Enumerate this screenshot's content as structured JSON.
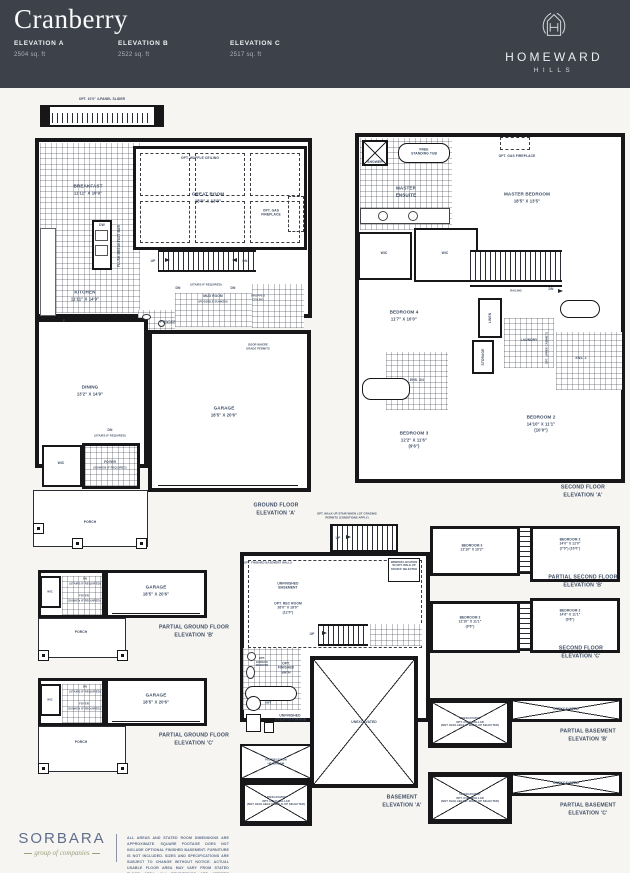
{
  "header": {
    "title": "Cranberry",
    "elevations": [
      {
        "label": "ELEVATION A",
        "area": "2504 sq. ft"
      },
      {
        "label": "ELEVATION B",
        "area": "2522 sq. ft"
      },
      {
        "label": "ELEVATION C",
        "area": "2517 sq. ft"
      }
    ],
    "brand": {
      "line1": "HOMEWARD",
      "line2": "HILLS"
    }
  },
  "colors": {
    "header_bg": "#3d424a",
    "page_bg": "#f6f5f2",
    "plan_ink": "#17171a",
    "plan_label": "#3d4c63",
    "brand_blue": "#5e6f8a",
    "brand_olive": "#9aa079"
  },
  "plans": {
    "ground": {
      "slider_note": "OPT. 10'0\" 4-PANEL SLIDER",
      "breakfast": {
        "name": "BREAKFAST",
        "dims": "11'11\" X 10'9\""
      },
      "great_room": {
        "name": "GREAT ROOM",
        "dims": "18'0\" X 13'0\""
      },
      "waffle_note": "OPT. WAFFLE CEILING",
      "fireplace_note": "OPT. GAS FIREPLACE",
      "kitchen": {
        "name": "KITCHEN",
        "dims": "11'11\" X 14'9\""
      },
      "dw": "DW",
      "fridge": "F",
      "flush_bar": "FLUSH BREAKFAST BAR",
      "up": "UP",
      "dn": "DN",
      "stairs_note": "(STAIRS IF REQUIRED)",
      "mud_room": {
        "name": "MUD ROOM",
        "note": "(POSSIBLE SUNKEN)"
      },
      "dropped_ceiling": "DROPPED CEILING",
      "powder": "POWDER",
      "door_note": "DOOR WHERE GRADE PERMITS",
      "dining": {
        "name": "DINING",
        "dims": "13'2\" X 14'9\""
      },
      "garage": {
        "name": "GARAGE",
        "dims": "18'5\" X 20'6\""
      },
      "foyer": {
        "name": "FOYER",
        "note": "(SUNKEN IF REQUIRED)"
      },
      "wic": "WIC",
      "porch": "PORCH",
      "caption": {
        "line1": "GROUND FLOOR",
        "line2": "ELEVATION 'A'"
      }
    },
    "second": {
      "shower": "SHOWER",
      "tub": "FREE STANDING TUB",
      "ensuite": "MASTER ENSUITE",
      "fireplace_note": "OPT. GAS FIREPLACE",
      "master": {
        "name": "MASTER BEDROOM",
        "dims": "18'5\" X 13'5\""
      },
      "wic1": "WIC",
      "wic2": "WIC",
      "railing": "RAILING",
      "dn": "DN",
      "bedroom4": {
        "name": "BEDROOM 4",
        "dims": "11'7\" X 10'0\""
      },
      "linen": "LINEN",
      "laundry": "LAUNDRY",
      "storage": "STORAGE",
      "cabinet_note": "OPT. UPPER CABINETS",
      "ens34": "ENS. 3/4",
      "ens2": "ENS. 2",
      "bedroom3": {
        "name": "BEDROOM 3",
        "dims": "12'2\" X 11'6\"",
        "note": "(9'6\")"
      },
      "bedroom2": {
        "name": "BEDROOM 2",
        "dims": "14'10\" X 11'1\"",
        "note": "(10'0\")"
      },
      "caption": {
        "line1": "SECOND FLOOR",
        "line2": "ELEVATION 'A'"
      }
    },
    "basement": {
      "walkup_note": "OPT. WALK-UP STAIR WHEN LOT GRADING PERMITS (CONDITIONS APPLY)",
      "up": "UP",
      "window_note": "WINDOW LOCATION W/ OPT. WALK-UP STAIR IF SELECTED",
      "wall_note": "OPT. FINISHED BASEMENT WALLS",
      "unfinished": "UNFINISHED BASEMENT",
      "rec_room": {
        "name": "OPT. REC ROOM",
        "dims": "26'0\" X 18'0\"",
        "note": "(12'0\")"
      },
      "egress_note": "OPT. EGRESS WINDOW",
      "bath_note": "OPT. FINISHED BATH",
      "hwt": "HWT",
      "utility": "UNFINISHED UTILITY/STORAGE",
      "low_headroom": "POSSIBLE LOW HEADROOM",
      "unexcavated": "UNEXCAVATED",
      "cold_cellar": {
        "line1": "UNEXCAVATED",
        "line2": "OPT. COLD CELLAR",
        "line3": "(NOT AVAILABLE IF WALK-UP SELECTED)"
      },
      "caption": {
        "line1": "BASEMENT",
        "line2": "ELEVATION 'A'"
      }
    },
    "partial_ground_b": {
      "dn": "DN",
      "stairs_note": "(STAIRS IF REQUIRED)",
      "foyer": {
        "name": "FOYER",
        "note": "(SUNKEN IF REQUIRED)"
      },
      "wic": "WIC",
      "garage": {
        "name": "GARAGE",
        "dims": "18'5\" X 20'6\""
      },
      "porch": "PORCH",
      "caption": {
        "line1": "PARTIAL GROUND FLOOR",
        "line2": "ELEVATION 'B'"
      }
    },
    "partial_ground_c": {
      "dn": "DN",
      "stairs_note": "(STAIRS IF REQUIRED)",
      "foyer": {
        "name": "FOYER",
        "note": "(SUNKEN IF REQUIRED)"
      },
      "wic": "WIC",
      "garage": {
        "name": "GARAGE",
        "dims": "18'5\" X 20'6\""
      },
      "porch": "PORCH",
      "caption": {
        "line1": "PARTIAL GROUND FLOOR",
        "line2": "ELEVATION 'C'"
      }
    },
    "partial_second_b": {
      "bedroom3": {
        "name": "BEDROOM 3",
        "dims": "12'10\" X 10'2\""
      },
      "bedroom2": {
        "name": "BEDROOM 2",
        "dims": "14'0\" X 12'0\"",
        "note": "(7'0\") (10'0\")"
      },
      "caption": {
        "line1": "PARTIAL SECOND FLOOR",
        "line2": "ELEVATION 'B'"
      }
    },
    "second_c": {
      "bedroom3": {
        "name": "BEDROOM 3",
        "dims": "12'10\" X 11'1\"",
        "note": "(9'6\")"
      },
      "bedroom2": {
        "name": "BEDROOM 2",
        "dims": "14'6\" X 11'1\"",
        "note": "(9'6\")"
      },
      "caption": {
        "line1": "SECOND FLOOR",
        "line2": "ELEVATION 'C'"
      }
    },
    "partial_basement_b": {
      "unexcavated": "UNEXCAVATED",
      "cold_cellar": {
        "line1": "UNEXCAVATED",
        "line2": "OPT. COLD CELLAR",
        "line3": "(NOT AVAILABLE IF WALK-UP SELECTED)"
      },
      "caption": {
        "line1": "PARTIAL BASEMENT",
        "line2": "ELEVATION 'B'"
      }
    },
    "partial_basement_c": {
      "unexcavated": "UNEXCAVATED",
      "cold_cellar": {
        "line1": "UNEXCAVATED",
        "line2": "OPT. COLD CELLAR",
        "line3": "(NOT AVAILABLE IF WALK-UP SELECTED)"
      },
      "caption": {
        "line1": "PARTIAL BASEMENT",
        "line2": "ELEVATION 'C'"
      }
    }
  },
  "footer": {
    "brand": "SORBARA",
    "brand_sub": "group of companies",
    "disclaimer": "ALL AREAS AND STATED ROOM DIMENSIONS ARE APPROXIMATE. SQUARE FOOTAGE DOES NOT INCLUDE OPTIONAL FINISHED BASEMENT. FURNITURE IS NOT INCLUDED. SIZES AND SPECIFICATIONS ARE SUBJECT TO CHANGE WITHOUT NOTICE. ACTUAL USABLE FLOOR AREA MAY VARY FROM STATED FLOOR AREA. ALL RENDERINGS ARE ARTIST'S CONCEPT. E. & O. E."
  }
}
